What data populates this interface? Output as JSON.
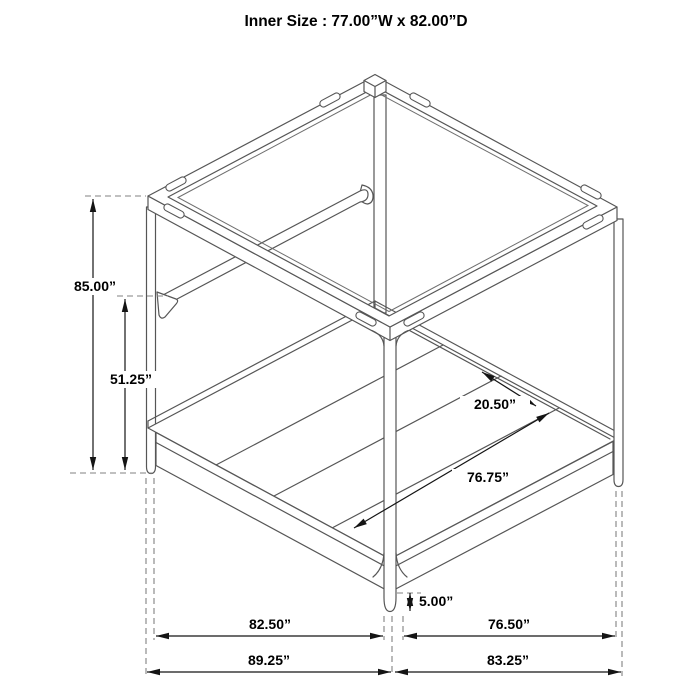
{
  "title": "Inner Size : 77.00”W x 82.00”D",
  "dims": {
    "overall_height": "85.00”",
    "headboard_rail_height": "51.25”",
    "slat_spacing": "20.50”",
    "slat_length": "76.75”",
    "leg_clearance": "5.00”",
    "base_width_inner": "82.50”",
    "base_depth_inner": "76.50”",
    "overall_width": "89.25”",
    "overall_depth": "83.25”"
  },
  "colors": {
    "background": "#ffffff",
    "structure_line": "#565656",
    "dimension_line": "#141414",
    "extension_dash": "#828282",
    "text": "#000000"
  }
}
